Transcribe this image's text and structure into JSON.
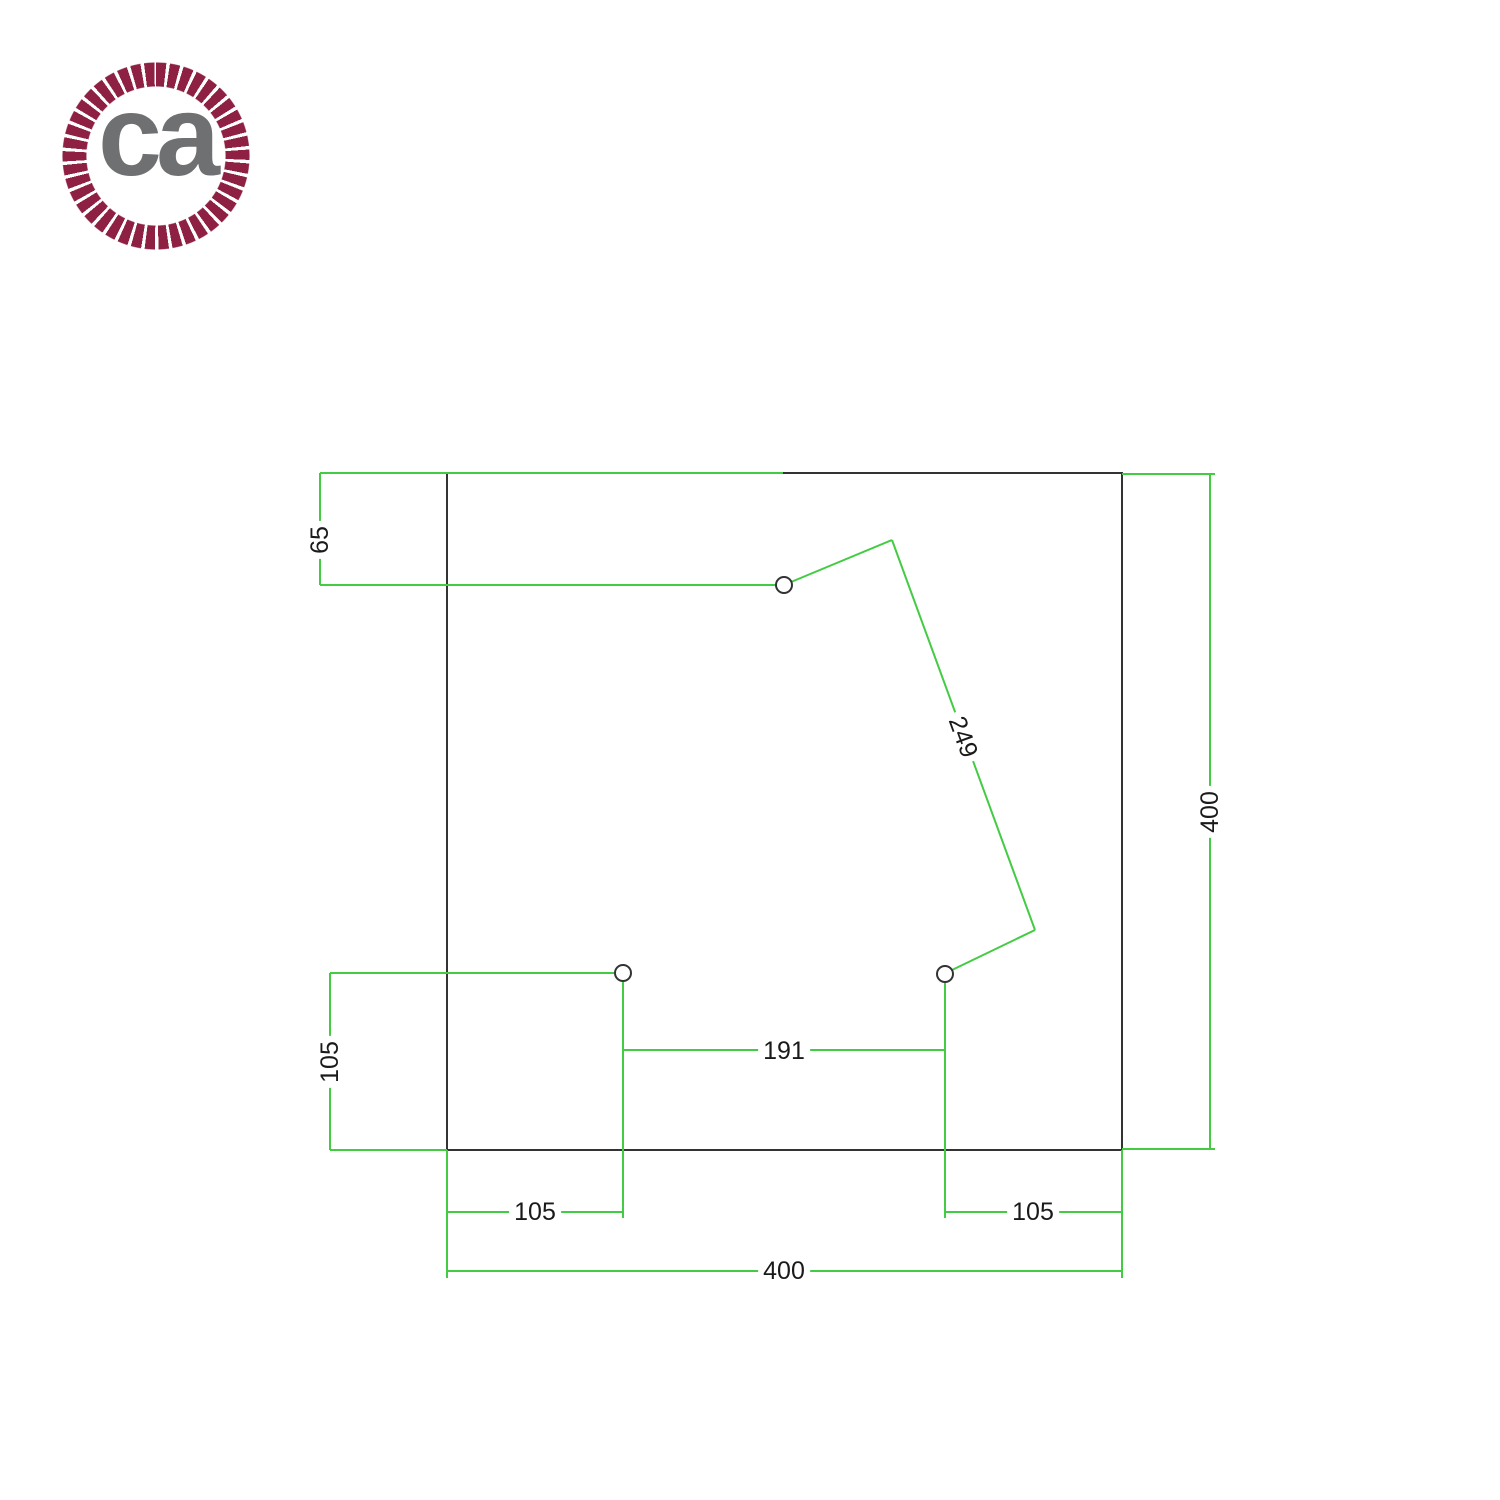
{
  "logo": {
    "text": "ca",
    "icon": "rope-circle"
  },
  "colors": {
    "bg": "#ffffff",
    "dim-green": "#44cb44",
    "outline": "#333333",
    "label-ink": "#1a1a1a",
    "rope": "#8e2143",
    "logo-gray": "#6e7072"
  },
  "drawing": {
    "labels": {
      "hole1_from_top": "65",
      "hole1_to_hole3_diagonal": "249",
      "right_side_height": "400",
      "holes_from_bottom": "105",
      "hole2_to_hole3": "191",
      "hole2_from_left": "105",
      "hole3_from_right": "105",
      "bottom_side_width": "400"
    }
  }
}
